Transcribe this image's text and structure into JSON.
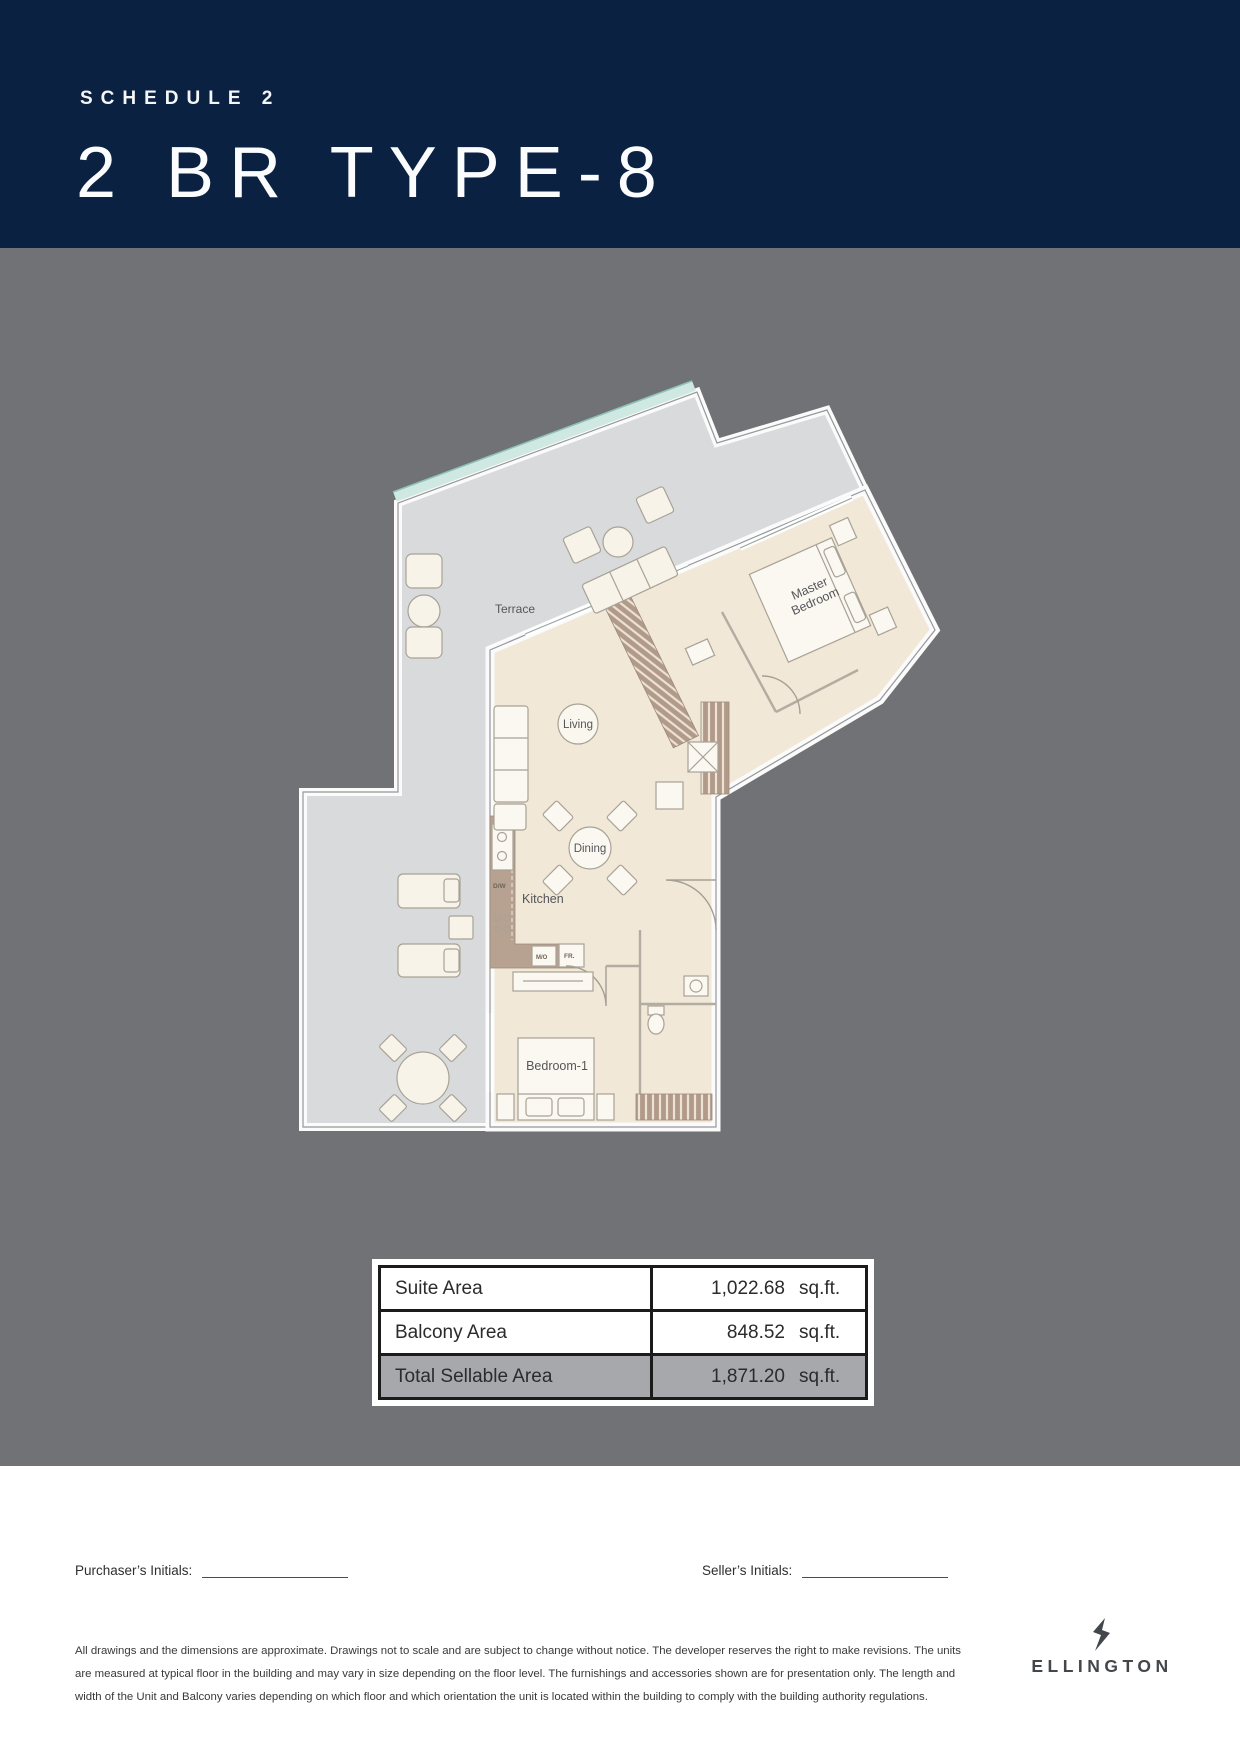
{
  "header": {
    "schedule": "SCHEDULE 2",
    "title": "2 BR TYPE-8"
  },
  "floor_plan": {
    "labels": {
      "terrace": "Terrace",
      "living": "Living",
      "dining": "Dining",
      "kitchen": "Kitchen",
      "bedroom1": "Bedroom-1",
      "master_line1": "Master",
      "master_line2": "Bedroom",
      "dw": "D/W",
      "mo": "M/O",
      "fr": "FR."
    }
  },
  "area_table": {
    "rows": [
      {
        "label": "Suite Area",
        "value": "1,022.68",
        "unit": "sq.ft."
      },
      {
        "label": "Balcony Area",
        "value": "848.52",
        "unit": "sq.ft."
      },
      {
        "label": "Total Sellable Area",
        "value": "1,871.20",
        "unit": "sq.ft."
      }
    ]
  },
  "signatures": {
    "purchaser_label": "Purchaser’s Initials:",
    "seller_label": "Seller’s Initials:"
  },
  "disclaimer": {
    "lines": [
      "All drawings and the dimensions are approximate. Drawings not to scale and are subject to change without notice. The developer reserves the right to make revisions. The units",
      "are measured at typical floor in the building and may vary in size depending on the floor level. The furnishings and accessories shown are for presentation only. The length and",
      "width of the Unit and Balcony varies depending on which floor and which orientation the unit is located within the building to comply with the building authority regulations."
    ]
  },
  "logo": {
    "name": "ELLINGTON"
  },
  "colors": {
    "header_navy": "#0a2142",
    "canvas_gray": "#717275",
    "terrace_gray": "#d9dadc",
    "interior_cream": "#f1e8d7",
    "glass_teal": "#cfe9e2",
    "wood_brown": "#b29a89",
    "table_total_bg": "#a7a8ab"
  }
}
